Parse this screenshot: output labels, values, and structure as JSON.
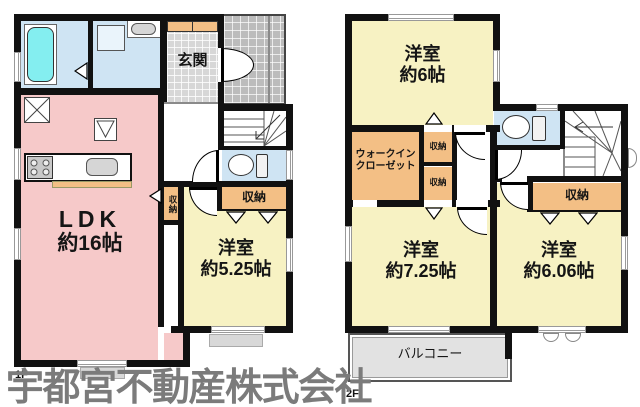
{
  "watermark": "宇都宮不動産株式会社",
  "floor1": {
    "label": "1F",
    "entrance": "玄関",
    "ldk": {
      "name": "LDK",
      "area": "約16帖"
    },
    "bedroom": {
      "name": "洋室",
      "area": "約5.25帖"
    },
    "closet_hall": "収納",
    "closet_bedroom": "収納"
  },
  "floor2": {
    "label": "2F",
    "bedroom_a": {
      "name": "洋室",
      "area": "約6帖"
    },
    "bedroom_b": {
      "name": "洋室",
      "area": "約7.25帖"
    },
    "bedroom_c": {
      "name": "洋室",
      "area": "約6.06帖"
    },
    "wic": {
      "line1": "ウォークイン",
      "line2": "クローゼット"
    },
    "closet_a": "収納",
    "closet_b": "収納",
    "closet_big": "収納",
    "balcony": "バルコニー"
  },
  "colors": {
    "wall": "#111111",
    "ldk": "#f6c9c9",
    "bedroom": "#f7f2c3",
    "closet": "#f3bf85",
    "water": "#cfe4f3",
    "tub": "#84eef0",
    "tile": "#d7d7d7",
    "tile_dark": "#bcbcbc",
    "balcony": "#e2e2e2",
    "step": "#d8d8d8",
    "fixture": "#d6d6d6",
    "watermark": "#7b7b7b"
  }
}
